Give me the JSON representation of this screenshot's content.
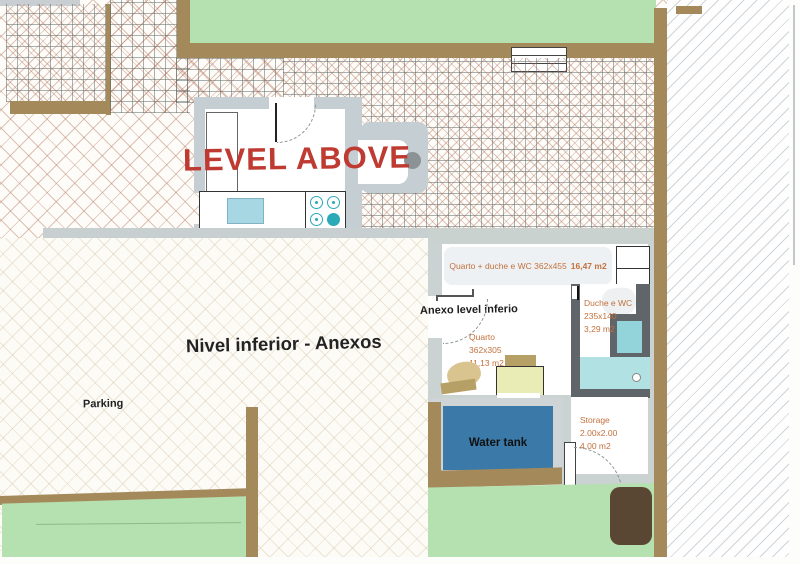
{
  "titles": {
    "level_above": "LEVEL ABOVE",
    "lower_level": "Nivel inferior - Anexos"
  },
  "labels": {
    "parking": "Parking",
    "anexo_pointer": "Anexo level inferio",
    "water_tank": "Water tank"
  },
  "rooms": {
    "suite": {
      "name": "Quarto + duche e WC 362x455",
      "area": "16,47 m2"
    },
    "quarto": {
      "name": "Quarto",
      "dims": "362x305",
      "area": "11,13 m2"
    },
    "duche": {
      "name": "Duche e WC",
      "dims": "235x140",
      "area": "3,29 m2"
    },
    "storage": {
      "name": "Storage",
      "dims": "2.00x2.00",
      "area": "4.00 m2"
    }
  },
  "colors": {
    "wall_brown": "#a48a5b",
    "grass_green": "#b5e0af",
    "water_blue": "#3b7aa8",
    "shower_teal": "#b2e1e3",
    "title_red": "#bf3a31",
    "label_orange": "#c2713d",
    "wall_gray": "#c6ced2",
    "dark_wall_gray": "#5f6569"
  }
}
